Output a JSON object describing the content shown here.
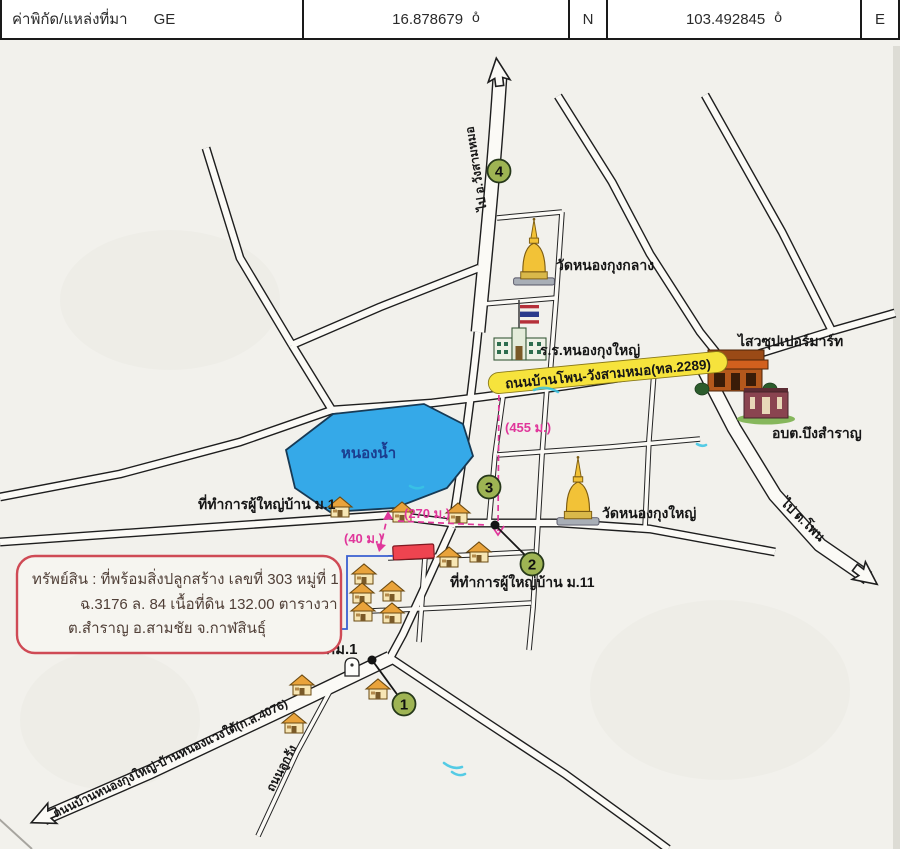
{
  "header": {
    "title": "ค่าพิกัด/แหล่งที่มา",
    "source": "GE",
    "latitude": "16.878679",
    "lat_hemisphere": "N",
    "longitude": "103.492845",
    "lon_hemisphere": "E",
    "degree_symbol": "o̊"
  },
  "property_note": {
    "line1": "ทรัพย์สิน :  ที่พร้อมสิ่งปลูกสร้าง  เลขที่ 303 หมู่ที่ 1",
    "line2": "ฉ.3176 ล. 84  เนื้อที่ดิน  132.00 ตารางวา",
    "line3": "ต.สำราญ อ.สามชัย จ.กาฬสินธุ์"
  },
  "map": {
    "labels": {
      "lake": "หนองน้ำ",
      "village_head_m1": "ที่ทำการผู้ใหญ่บ้าน ม.1",
      "village_head_m11": "ที่ทำการผู้ใหญ่บ้าน ม.11",
      "wat_nong_kung_klang": "วัดหนองกุงกลาง",
      "wat_nong_kung_yai": "วัดหนองกุงใหญ่",
      "school": "ร.ร.หนองกุงใหญ่",
      "supermarket": "ไสวซุปเปอร์มาร์ท",
      "sao_office": "อบต.บึงสำราญ",
      "km_marker": "กม.1"
    },
    "roads": {
      "route_2289": "ถนนบ้านโพน-วังสามหมอ(ทล.2289)",
      "route_4076": "ถนนบ้านหนองกุงใหญ่-บ้านหนองแวงใต้(ก.ส.4076)",
      "dirt_road": "ถนนลูกรัง",
      "to_wang_sam_mo": "ไป อ.วังสามหมอ",
      "to_phon": "ไป ต.โพน"
    },
    "distances": {
      "d40": "(40 ม.)",
      "d270": "(270 ม.)",
      "d455": "(455 ม.)"
    },
    "markers": {
      "m1": "1",
      "m2": "2",
      "m3": "3",
      "m4": "4"
    }
  },
  "colors": {
    "lake": "#35a9e8",
    "distance_pink": "#e0379b",
    "marker_green": "#9eb453",
    "property_red": "#ee4450",
    "note_border": "#cf4a55",
    "highlight_yellow": "#f6e33c"
  }
}
